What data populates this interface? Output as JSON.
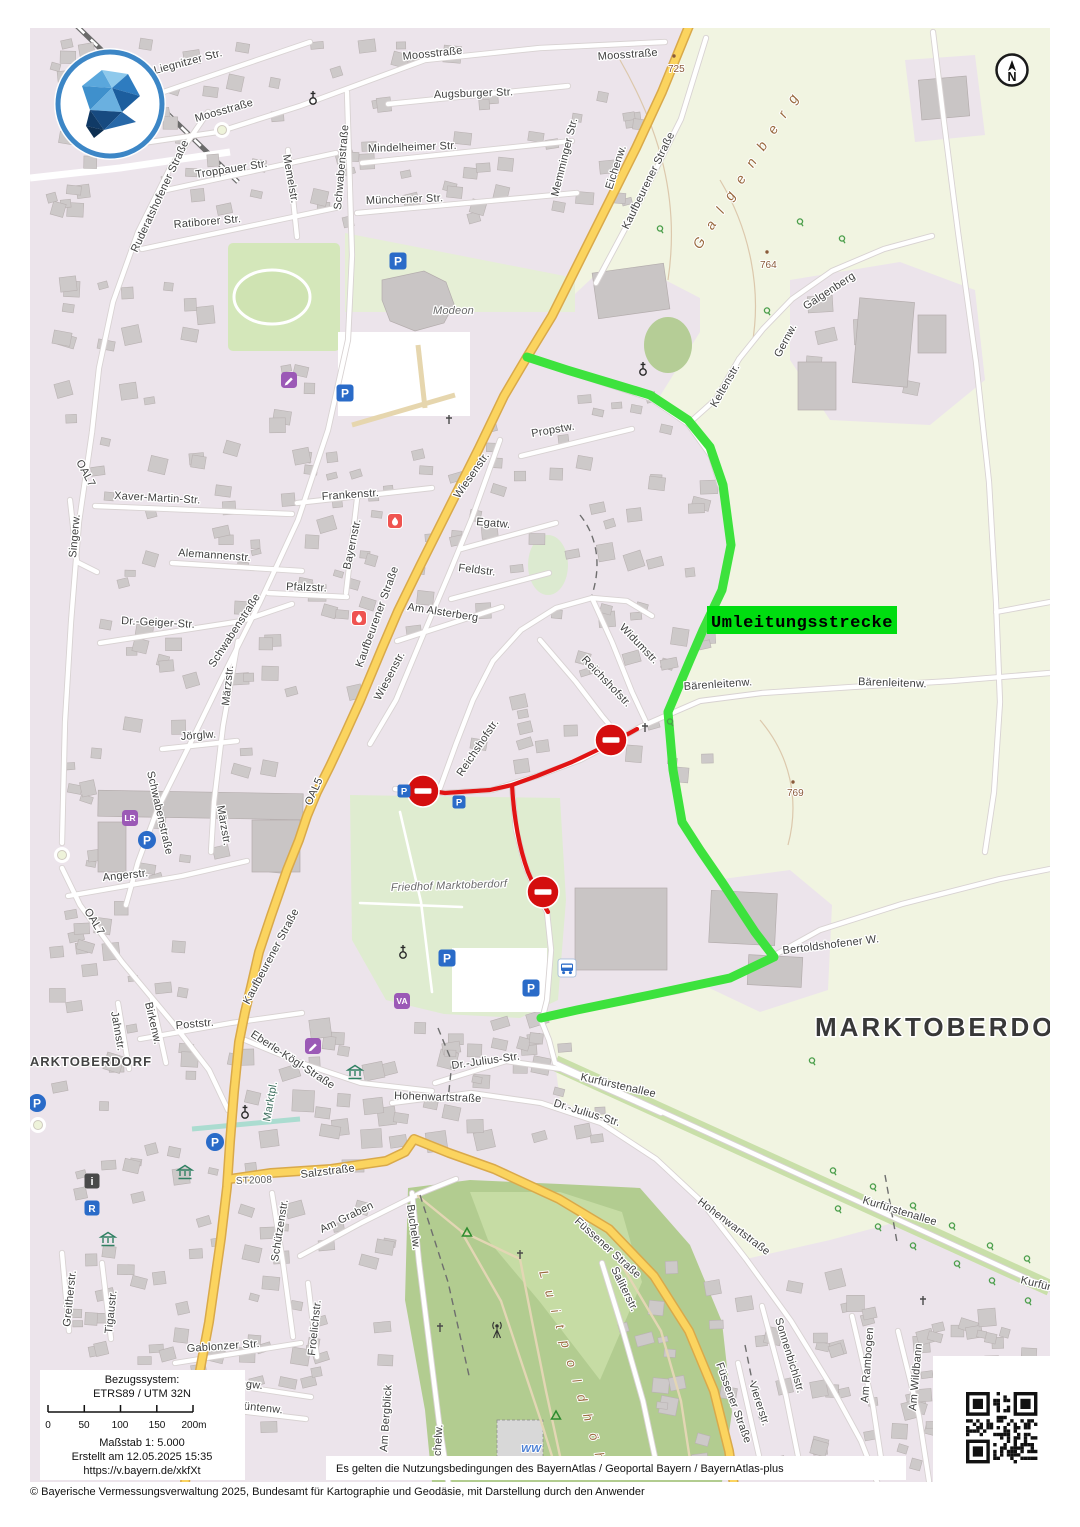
{
  "map": {
    "city_label": "MARKTOBERDORF",
    "detour": {
      "label": "Umleitungsstrecke"
    },
    "labels": {
      "liegnitzer": "Liegnitzer Str.",
      "moosstrasse": "Moosstraße",
      "augsburger": "Augsburger Str.",
      "mindelheimer": "Mindelheimer Str.",
      "muenchener": "Münchener Str.",
      "troppauer": "Troppauer Str.",
      "memelstr": "Memelstr.",
      "ratiborer": "Ratiborer Str.",
      "ruderatshofener": "Ruderatshofener Straße",
      "schwabenstrasse": "Schwabenstraße",
      "memminger": "Memminger Str.",
      "eichenw": "Eichenw.",
      "kaufbeurener": "Kaufbeurener Straße",
      "galgenberg": "Galgenberg",
      "gernw": "Gernw.",
      "keltenstr": "Keltenstr.",
      "propstw": "Propstw.",
      "wiesenstr": "Wiesenstr.",
      "frankenstr": "Frankenstr.",
      "xaver": "Xaver-Martin-Str.",
      "singerw": "Singerw.",
      "oal7": "OAL7",
      "oal5": "OAL5",
      "alemannenstr": "Alemannenstr.",
      "bayernstr": "Bayernstr.",
      "pfalzstr": "Pfalzstr.",
      "drgeiger": "Dr.-Geiger-Str.",
      "maerzstr": "Märzstr.",
      "egatw": "Egatw.",
      "feldstr": "Feldstr.",
      "amalsterberg": "Am Alsterberg",
      "widumstr": "Widumstr.",
      "reichshofstr": "Reichshofstr.",
      "baerenleitenw": "Bärenleitenw.",
      "joerglw": "Jörglw.",
      "angerstr": "Angerstr.",
      "friedhof": "Friedhof Marktoberdorf",
      "bertoldshofener": "Bertoldshofener W.",
      "jahnstr": "Jahnstr.",
      "birkenw": "Birkenw.",
      "poststr": "Poststr.",
      "eberlekoegl": "Eberle-Kögl-Straße",
      "marktpl": "Marktpl.",
      "hohenwartstrasse": "Hohenwartstraße",
      "drjulius": "Dr.-Julius-Str.",
      "kurfuerstenallee": "Kurfürstenallee",
      "st2008": "ST2008",
      "salzstrasse": "Salzstraße",
      "amgraben": "Am Graben",
      "buchelw": "Buchelw.",
      "fuessener": "Füssener Straße",
      "saliterstr": "Saliterstr.",
      "sonnenbichlstr": "Sonnenbichlstr.",
      "viererstr": "Viererstr.",
      "amrambogen": "Am Rambogen",
      "amwildbann": "Am Wildbann",
      "gablonzer": "Gablonzer Str.",
      "saeulingw": "Säulingw.",
      "gruentenw": "Grüntenw.",
      "attstr": "attstr.",
      "ambergblick": "Am Bergblick",
      "schuetzenstr": "Schützenstr.",
      "froelichstr": "Froelichstr.",
      "greitherstr": "Greitherstr.",
      "tigaustr": "Tigaustr.",
      "modeon": "Modeon",
      "luitpold": "Luitpoldhöhe",
      "ww": "WW"
    },
    "elevations": {
      "e725": "725",
      "e764": "764",
      "e769": "769"
    },
    "icon_letters": {
      "parking": "P",
      "lr": "LR",
      "va": "VA",
      "r": "R",
      "info": "i"
    }
  },
  "north_indicator": {
    "letter": "N"
  },
  "scale_panel": {
    "ref_label": "Bezugssystem:",
    "ref_value": "ETRS89 / UTM 32N",
    "ticks": [
      "0",
      "50",
      "100",
      "150",
      "200m"
    ],
    "scale": "Maßstab 1: 5.000",
    "created": "Erstellt am 12.05.2025 15:35",
    "url": "https://v.bayern.de/xkfXt"
  },
  "attribution": {
    "terms": "Es gelten die Nutzungsbedingungen des BayernAtlas / Geoportal Bayern / BayernAtlas-plus",
    "copyright": "© Bayerische Vermessungsverwaltung 2025, Bundesamt für Kartographie und Geodäsie, mit Darstellung durch den Anwender"
  },
  "colors": {
    "detour_route": "#3de23d",
    "detour_label_bg": "#00dd10",
    "closed_route": "#e11414",
    "road_primary": "#fbd45f",
    "residential": "#ece4eb",
    "field": "#f1f4e1"
  }
}
